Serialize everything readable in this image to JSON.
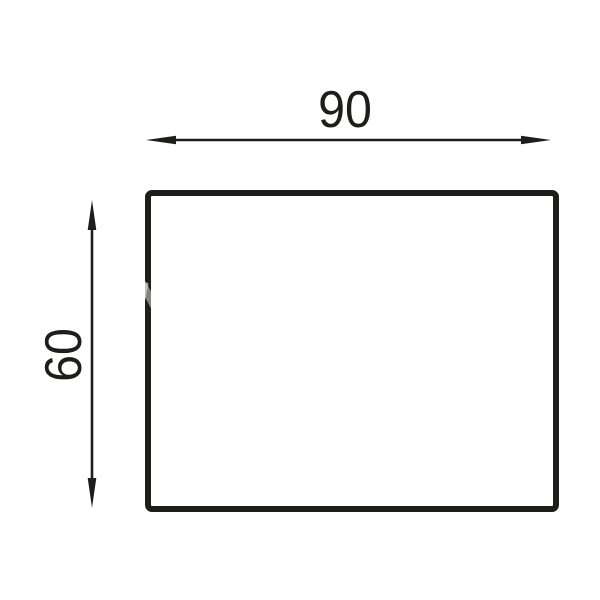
{
  "dimensions": {
    "width_label": "90",
    "height_label": "60"
  },
  "colors": {
    "line": "#1d1d1b",
    "background": "#ffffff"
  },
  "icons": {
    "width_arrow": "horizontal-double-headed-arrow",
    "height_arrow": "vertical-double-headed-arrow"
  }
}
